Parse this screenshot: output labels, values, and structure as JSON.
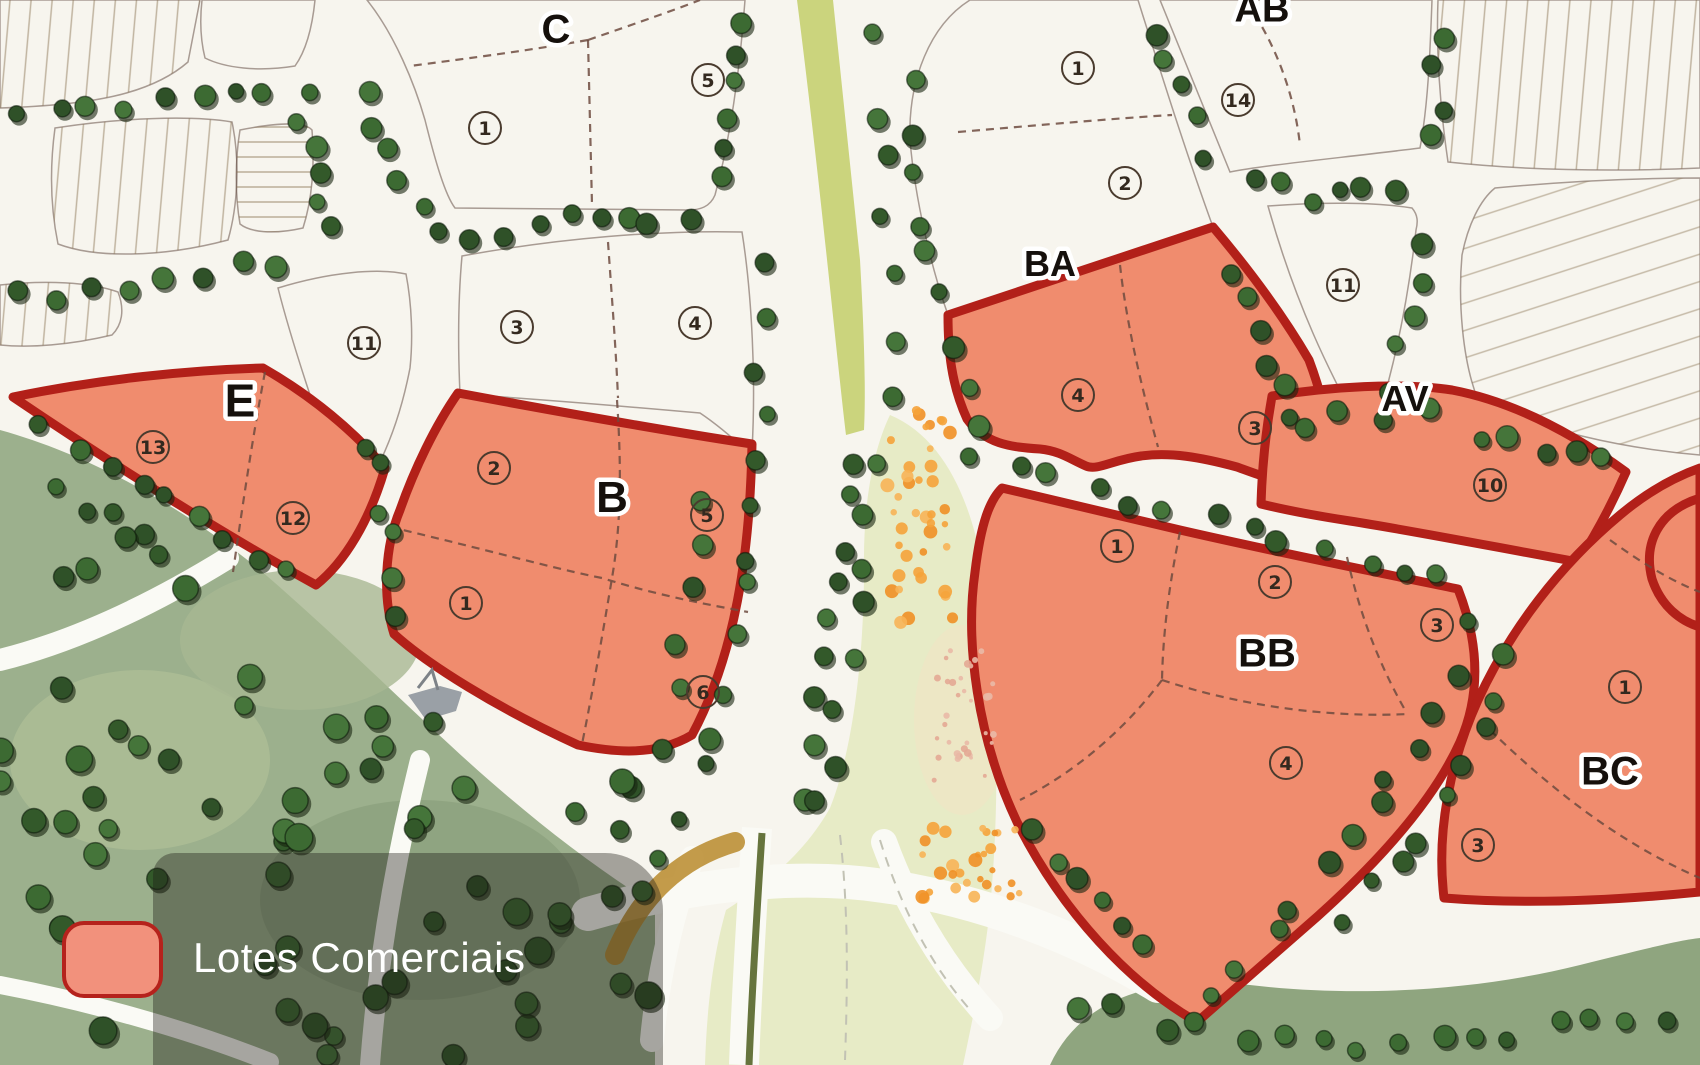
{
  "legend": {
    "label": "Lotes Comerciais",
    "swatch_fill": "#F2917C",
    "swatch_border": "#B5221C"
  },
  "colors": {
    "commercial_fill": "#F08C6E",
    "commercial_stroke": "#B22019",
    "residential_mauve": "#B28C85",
    "residential_pink": "#CDA49E",
    "residential_cream": "#F5E8C6",
    "residential_peach": "#F2AC80",
    "forest": "#9CB08D",
    "meadow": "#E7EBC6",
    "median": "#CBD47D",
    "bottom_band": "#8FA57F",
    "road": "#FAFAF5",
    "tree": "#3C6A32"
  },
  "blocks": [
    {
      "id": "C",
      "label": "C",
      "label_pos": {
        "x": 556,
        "y": 28
      },
      "label_size": 40,
      "type": "residential",
      "lots": [
        {
          "n": "1",
          "x": 485,
          "y": 128
        },
        {
          "n": "5",
          "x": 708,
          "y": 80
        }
      ]
    },
    {
      "id": "C-south",
      "label": "",
      "label_pos": {
        "x": 0,
        "y": 0
      },
      "label_size": 0,
      "type": "residential",
      "lots": [
        {
          "n": "3",
          "x": 517,
          "y": 327
        },
        {
          "n": "4",
          "x": 695,
          "y": 323
        }
      ]
    },
    {
      "id": "E-north",
      "label": "",
      "label_pos": {
        "x": 0,
        "y": 0
      },
      "label_size": 0,
      "type": "residential",
      "lots": [
        {
          "n": "11",
          "x": 364,
          "y": 343
        }
      ]
    },
    {
      "id": "E",
      "label": "E",
      "label_pos": {
        "x": 240,
        "y": 400
      },
      "label_size": 46,
      "type": "commercial",
      "lots": [
        {
          "n": "13",
          "x": 153,
          "y": 447
        },
        {
          "n": "12",
          "x": 293,
          "y": 518
        }
      ]
    },
    {
      "id": "B",
      "label": "B",
      "label_pos": {
        "x": 612,
        "y": 496
      },
      "label_size": 44,
      "type": "commercial",
      "lots": [
        {
          "n": "2",
          "x": 494,
          "y": 468
        },
        {
          "n": "1",
          "x": 466,
          "y": 603
        },
        {
          "n": "5",
          "x": 707,
          "y": 515
        },
        {
          "n": "6",
          "x": 703,
          "y": 692
        }
      ]
    },
    {
      "id": "BA-north",
      "label": "BA",
      "label_pos": {
        "x": 1050,
        "y": 263
      },
      "label_size": 36,
      "type": "residential",
      "lots": [
        {
          "n": "1",
          "x": 1078,
          "y": 68
        },
        {
          "n": "2",
          "x": 1125,
          "y": 183
        }
      ]
    },
    {
      "id": "BA",
      "label": "",
      "label_pos": {
        "x": 0,
        "y": 0
      },
      "label_size": 0,
      "type": "commercial",
      "lots": [
        {
          "n": "4",
          "x": 1078,
          "y": 395
        },
        {
          "n": "3",
          "x": 1255,
          "y": 428
        }
      ]
    },
    {
      "id": "AB",
      "label": "AB",
      "label_pos": {
        "x": 1262,
        "y": 8
      },
      "label_size": 38,
      "type": "residential",
      "lots": [
        {
          "n": "14",
          "x": 1238,
          "y": 100
        }
      ]
    },
    {
      "id": "AV-north",
      "label": "",
      "label_pos": {
        "x": 0,
        "y": 0
      },
      "label_size": 0,
      "type": "residential",
      "lots": [
        {
          "n": "11",
          "x": 1343,
          "y": 285
        }
      ]
    },
    {
      "id": "AV",
      "label": "AV",
      "label_pos": {
        "x": 1405,
        "y": 398
      },
      "label_size": 36,
      "type": "commercial",
      "lots": [
        {
          "n": "10",
          "x": 1490,
          "y": 485
        }
      ]
    },
    {
      "id": "BB",
      "label": "BB",
      "label_pos": {
        "x": 1267,
        "y": 652
      },
      "label_size": 40,
      "type": "commercial",
      "lots": [
        {
          "n": "1",
          "x": 1117,
          "y": 546
        },
        {
          "n": "2",
          "x": 1275,
          "y": 582
        },
        {
          "n": "3",
          "x": 1437,
          "y": 625
        },
        {
          "n": "4",
          "x": 1286,
          "y": 763
        }
      ]
    },
    {
      "id": "BC",
      "label": "BC",
      "label_pos": {
        "x": 1610,
        "y": 770
      },
      "label_size": 40,
      "type": "commercial",
      "lots": [
        {
          "n": "1",
          "x": 1625,
          "y": 687
        },
        {
          "n": "3",
          "x": 1478,
          "y": 845
        }
      ]
    }
  ]
}
